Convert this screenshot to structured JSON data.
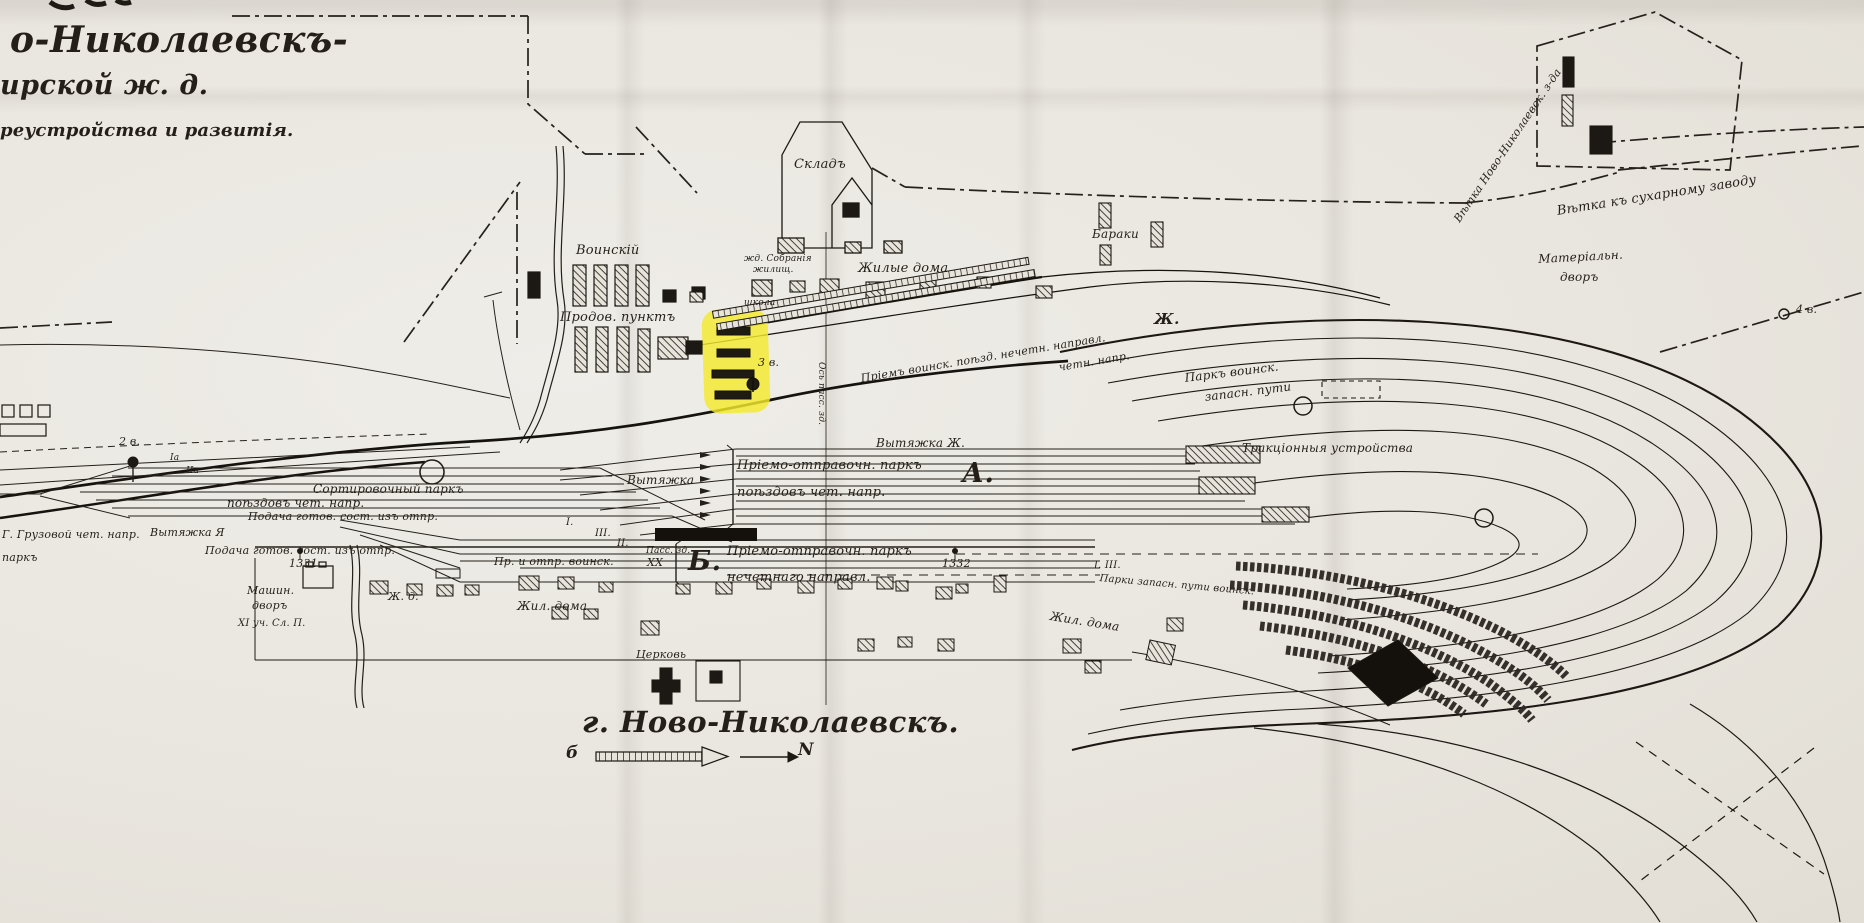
{
  "document": {
    "type": "scanned railway station plan",
    "city_caption": "г. Ново-Николаевскъ.",
    "title_fragments": [
      "о-Николаевскъ-",
      "ирской ж. д.",
      "реустройства и развитія."
    ]
  },
  "colors": {
    "paper": "#e9e6df",
    "ink": "#241f19",
    "highlight_marker": "#f3e92c"
  },
  "compass": {
    "left_letter": "б",
    "right_letter": "N"
  },
  "labels": [
    {
      "id": "title-line-1",
      "text": "о-Николаевскъ-",
      "x": 10,
      "y": 22,
      "fs": 36,
      "cls": "script"
    },
    {
      "id": "title-line-2",
      "text": "ирской ж. д.",
      "x": 0,
      "y": 72,
      "fs": 27,
      "cls": "script"
    },
    {
      "id": "title-line-3",
      "text": "реустройства и развитія.",
      "x": 0,
      "y": 122,
      "fs": 18,
      "cls": "b"
    },
    {
      "id": "label-sklad",
      "text": "Складъ",
      "x": 794,
      "y": 158,
      "fs": 13
    },
    {
      "id": "label-zhd-sobranie",
      "text": "жд. Собранія",
      "x": 744,
      "y": 255,
      "fs": 9
    },
    {
      "id": "label-zhilishch",
      "text": "жилищ.",
      "x": 753,
      "y": 266,
      "fs": 9
    },
    {
      "id": "label-shkola",
      "text": "школа",
      "x": 744,
      "y": 299,
      "fs": 9
    },
    {
      "id": "label-voinskiy",
      "text": "Воинскій",
      "x": 576,
      "y": 244,
      "fs": 13
    },
    {
      "id": "label-prodov-punkt",
      "text": "Продов. пунктъ",
      "x": 560,
      "y": 311,
      "fs": 13
    },
    {
      "id": "label-zhilye-doma-top",
      "text": "Жилые дома",
      "x": 858,
      "y": 262,
      "fs": 13
    },
    {
      "id": "label-baraki",
      "text": "Бараки",
      "x": 1092,
      "y": 228,
      "fs": 12
    },
    {
      "id": "label-materialn",
      "text": "Матеріальн.",
      "x": 1538,
      "y": 253,
      "fs": 12,
      "rot": -3
    },
    {
      "id": "label-materialn-dvor",
      "text": "дворъ",
      "x": 1560,
      "y": 271,
      "fs": 12
    },
    {
      "id": "label-vetka-zavod",
      "text": "Вѣтка Ново-Николаевск. з-да",
      "x": 1452,
      "y": 218,
      "fs": 11,
      "rot": -56
    },
    {
      "id": "label-vetka-suharny",
      "text": "Вѣтка къ сухарному заводу",
      "x": 1556,
      "y": 205,
      "fs": 13,
      "rot": -9
    },
    {
      "id": "label-priem-voinsk",
      "text": "Пріемъ воинск. поѣзд. нечетн. направл.",
      "x": 860,
      "y": 373,
      "fs": 11,
      "rot": -9.5
    },
    {
      "id": "label-chetn-napr",
      "text": "четн. напр.",
      "x": 1058,
      "y": 362,
      "fs": 11,
      "rot": -9.5
    },
    {
      "id": "label-zh-letter",
      "text": "Ж.",
      "x": 1154,
      "y": 312,
      "fs": 15,
      "cls": "script"
    },
    {
      "id": "label-park-voinsk",
      "text": "Паркъ воинск.",
      "x": 1184,
      "y": 372,
      "fs": 12,
      "rot": -7
    },
    {
      "id": "label-zapasn-puti",
      "text": "запасн. пути",
      "x": 1204,
      "y": 391,
      "fs": 12,
      "rot": -7
    },
    {
      "id": "label-vytyazhka-zh",
      "text": "Вытяжка Ж.",
      "x": 876,
      "y": 437,
      "fs": 12
    },
    {
      "id": "label-park-a-1",
      "text": "Пріемо-отправочн. паркъ",
      "x": 737,
      "y": 459,
      "fs": 13
    },
    {
      "id": "label-park-a-2",
      "text": "поѣздовъ чет. напр.",
      "x": 737,
      "y": 486,
      "fs": 13
    },
    {
      "id": "label-a-letter",
      "text": "А.",
      "x": 962,
      "y": 460,
      "fs": 27,
      "cls": "script"
    },
    {
      "id": "label-vytyazhka-center",
      "text": "Вытяжка",
      "x": 627,
      "y": 474,
      "fs": 12
    },
    {
      "id": "label-sortirovochny",
      "text": "Сортировочный паркъ",
      "x": 313,
      "y": 483,
      "fs": 12
    },
    {
      "id": "label-sort-2",
      "text": "поѣздовъ чет. напр.",
      "x": 227,
      "y": 497,
      "fs": 12
    },
    {
      "id": "label-podacha-1",
      "text": "Подача готов. сост. изъ отпр.",
      "x": 248,
      "y": 511,
      "fs": 11
    },
    {
      "id": "label-gruzovoy",
      "text": "Г. Грузовой чет. напр.",
      "x": 2,
      "y": 529,
      "fs": 11
    },
    {
      "id": "label-vytyazhka-ya",
      "text": "Вытяжка Я",
      "x": 150,
      "y": 527,
      "fs": 11
    },
    {
      "id": "label-podacha-2",
      "text": "Подача готов. сост. изъ отпр.",
      "x": 205,
      "y": 545,
      "fs": 11
    },
    {
      "id": "label-park-fragment",
      "text": "паркъ",
      "x": 2,
      "y": 552,
      "fs": 11
    },
    {
      "id": "label-pr-otpr-voinsk",
      "text": "Пр. и отпр. воинск.",
      "x": 494,
      "y": 556,
      "fs": 11
    },
    {
      "id": "label-b-letter",
      "text": "Б.",
      "x": 688,
      "y": 548,
      "fs": 27,
      "cls": "script"
    },
    {
      "id": "label-park-b-1",
      "text": "Пріемо-отправочн. паркъ",
      "x": 727,
      "y": 545,
      "fs": 13
    },
    {
      "id": "label-park-b-2",
      "text": "нечетнаго направл.",
      "x": 727,
      "y": 571,
      "fs": 13
    },
    {
      "id": "label-pass-zd",
      "text": "Пасс. зд.",
      "x": 646,
      "y": 547,
      "fs": 9
    },
    {
      "id": "label-1331",
      "text": "1331",
      "x": 289,
      "y": 558,
      "fs": 11
    },
    {
      "id": "label-1332",
      "text": "1332",
      "x": 942,
      "y": 558,
      "fs": 11
    },
    {
      "id": "label-zh-d",
      "text": "Ж. д.",
      "x": 388,
      "y": 591,
      "fs": 11
    },
    {
      "id": "label-zhil-doma-center",
      "text": "Жил. дома",
      "x": 517,
      "y": 600,
      "fs": 12
    },
    {
      "id": "label-tserkov",
      "text": "Церковь",
      "x": 636,
      "y": 649,
      "fs": 11
    },
    {
      "id": "label-zhil-doma-right",
      "text": "Жил. дома",
      "x": 1051,
      "y": 610,
      "fs": 12,
      "rot": 9
    },
    {
      "id": "label-mashin",
      "text": "Машин.",
      "x": 247,
      "y": 585,
      "fs": 11
    },
    {
      "id": "label-mashin-dvor",
      "text": "дворъ",
      "x": 252,
      "y": 600,
      "fs": 11
    },
    {
      "id": "label-uchastok",
      "text": "XI уч. Сл. П.",
      "x": 238,
      "y": 619,
      "fs": 10
    },
    {
      "id": "label-city",
      "text": "г. Ново-Николаевскъ.",
      "x": 582,
      "y": 708,
      "fs": 29,
      "cls": "script"
    },
    {
      "id": "label-compass-b",
      "text": "б",
      "x": 566,
      "y": 745,
      "fs": 17,
      "cls": "b"
    },
    {
      "id": "label-compass-n",
      "text": "N",
      "x": 798,
      "y": 742,
      "fs": 17,
      "cls": "b"
    },
    {
      "id": "label-verst-2",
      "text": "2 в.",
      "x": 119,
      "y": 436,
      "fs": 11
    },
    {
      "id": "label-verst-3",
      "text": "3 в.",
      "x": 758,
      "y": 357,
      "fs": 11
    },
    {
      "id": "label-verst-4",
      "text": "4 в.",
      "x": 1796,
      "y": 304,
      "fs": 11
    },
    {
      "id": "label-traktsionnye",
      "text": "Тракціонныя устройства",
      "x": 1242,
      "y": 442,
      "fs": 12
    },
    {
      "id": "label-os-pass-zd",
      "text": "Ось пасс. зд.",
      "x": 816,
      "y": 362,
      "fs": 9,
      "cls": "vert"
    },
    {
      "id": "label-switch-1a",
      "text": "Iа",
      "x": 170,
      "y": 454,
      "fs": 9
    },
    {
      "id": "label-switch-2a",
      "text": "IIа",
      "x": 186,
      "y": 467,
      "fs": 9
    },
    {
      "id": "label-track-i",
      "text": "I.",
      "x": 566,
      "y": 518,
      "fs": 10
    },
    {
      "id": "label-track-iii",
      "text": "III.",
      "x": 595,
      "y": 529,
      "fs": 10
    },
    {
      "id": "label-track-ii",
      "text": "II.",
      "x": 617,
      "y": 539,
      "fs": 10
    },
    {
      "id": "label-switch-xx",
      "text": "XX",
      "x": 647,
      "y": 557,
      "fs": 11
    },
    {
      "id": "label-switch-right",
      "text": "I. III.",
      "x": 1094,
      "y": 561,
      "fs": 10
    },
    {
      "id": "label-parki-zapasn",
      "text": "Парки запасн. пути воинск.",
      "x": 1100,
      "y": 574,
      "fs": 10,
      "rot": 5
    }
  ]
}
